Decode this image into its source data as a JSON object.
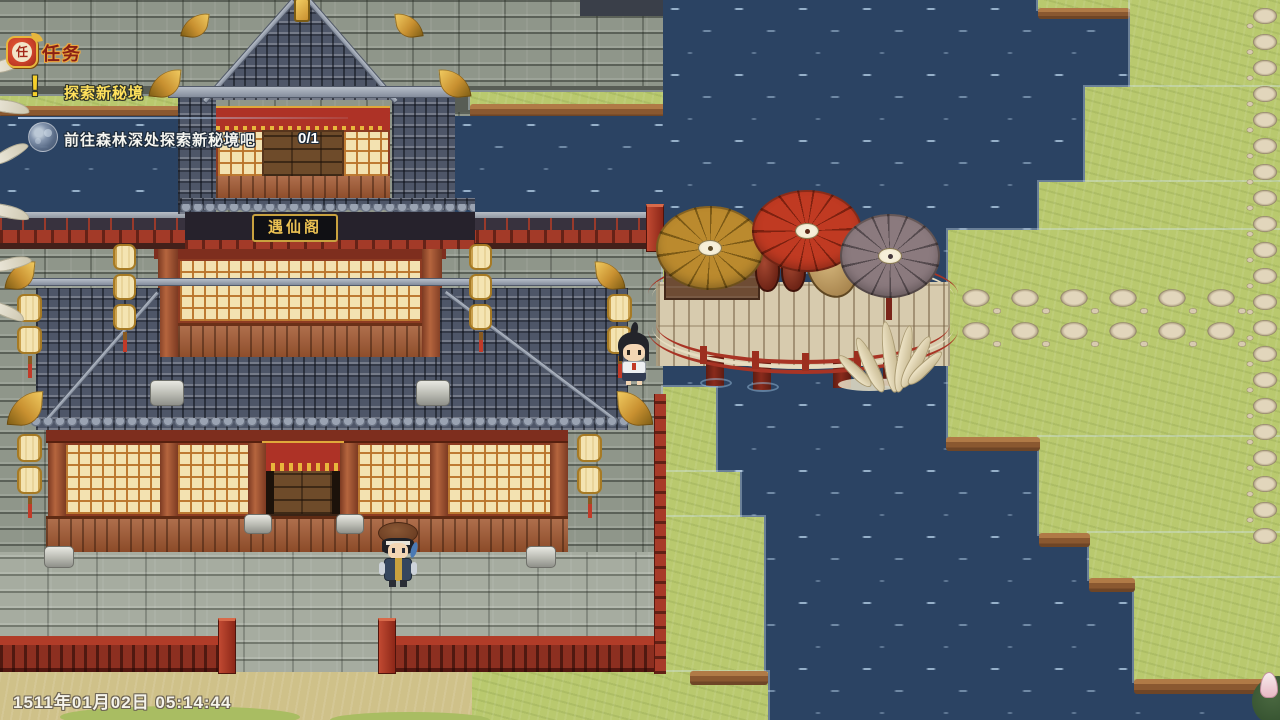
{
  "app": {
    "type": "rpg-game-screen",
    "resolution": "1280x720"
  },
  "quest_panel": {
    "badge_glyph": "任",
    "header_label": "任务",
    "alert_glyph": "!",
    "quest_title": "探索新秘境",
    "objective_text": "前往森林深处探索新秘境吧",
    "progress_counter": "0/1"
  },
  "building": {
    "plaque_text": "遇仙阁"
  },
  "status_bar": {
    "datetime_text": "1511年01月02日 05:14:44"
  },
  "icons": {
    "quest_badge": "red-seal-stamp-icon",
    "quest_alert": "exclamation-icon",
    "objective_bullet": "moon-orb-icon"
  },
  "palette": {
    "water": "#2b4363",
    "water_sparkle": "#a9c2d8",
    "grass": "#b9c96e",
    "dirt_edge": "#8a5830",
    "roof_tile": "#4e5668",
    "brick_wall": "#8f968a",
    "pavement": "#a6aca0",
    "wood_red": "#a2572f",
    "lattice_cream": "#f3e2b1",
    "accent_red": "#a83425",
    "gold": "#d9a940",
    "bridge_plank": "#d7cbae",
    "umbrella_gold": "#bb8a2e",
    "umbrella_red": "#c03a22",
    "umbrella_gray": "#8b7a7e",
    "quest_title_text": "#ffe15c",
    "hud_text": "#f5f3ea"
  }
}
